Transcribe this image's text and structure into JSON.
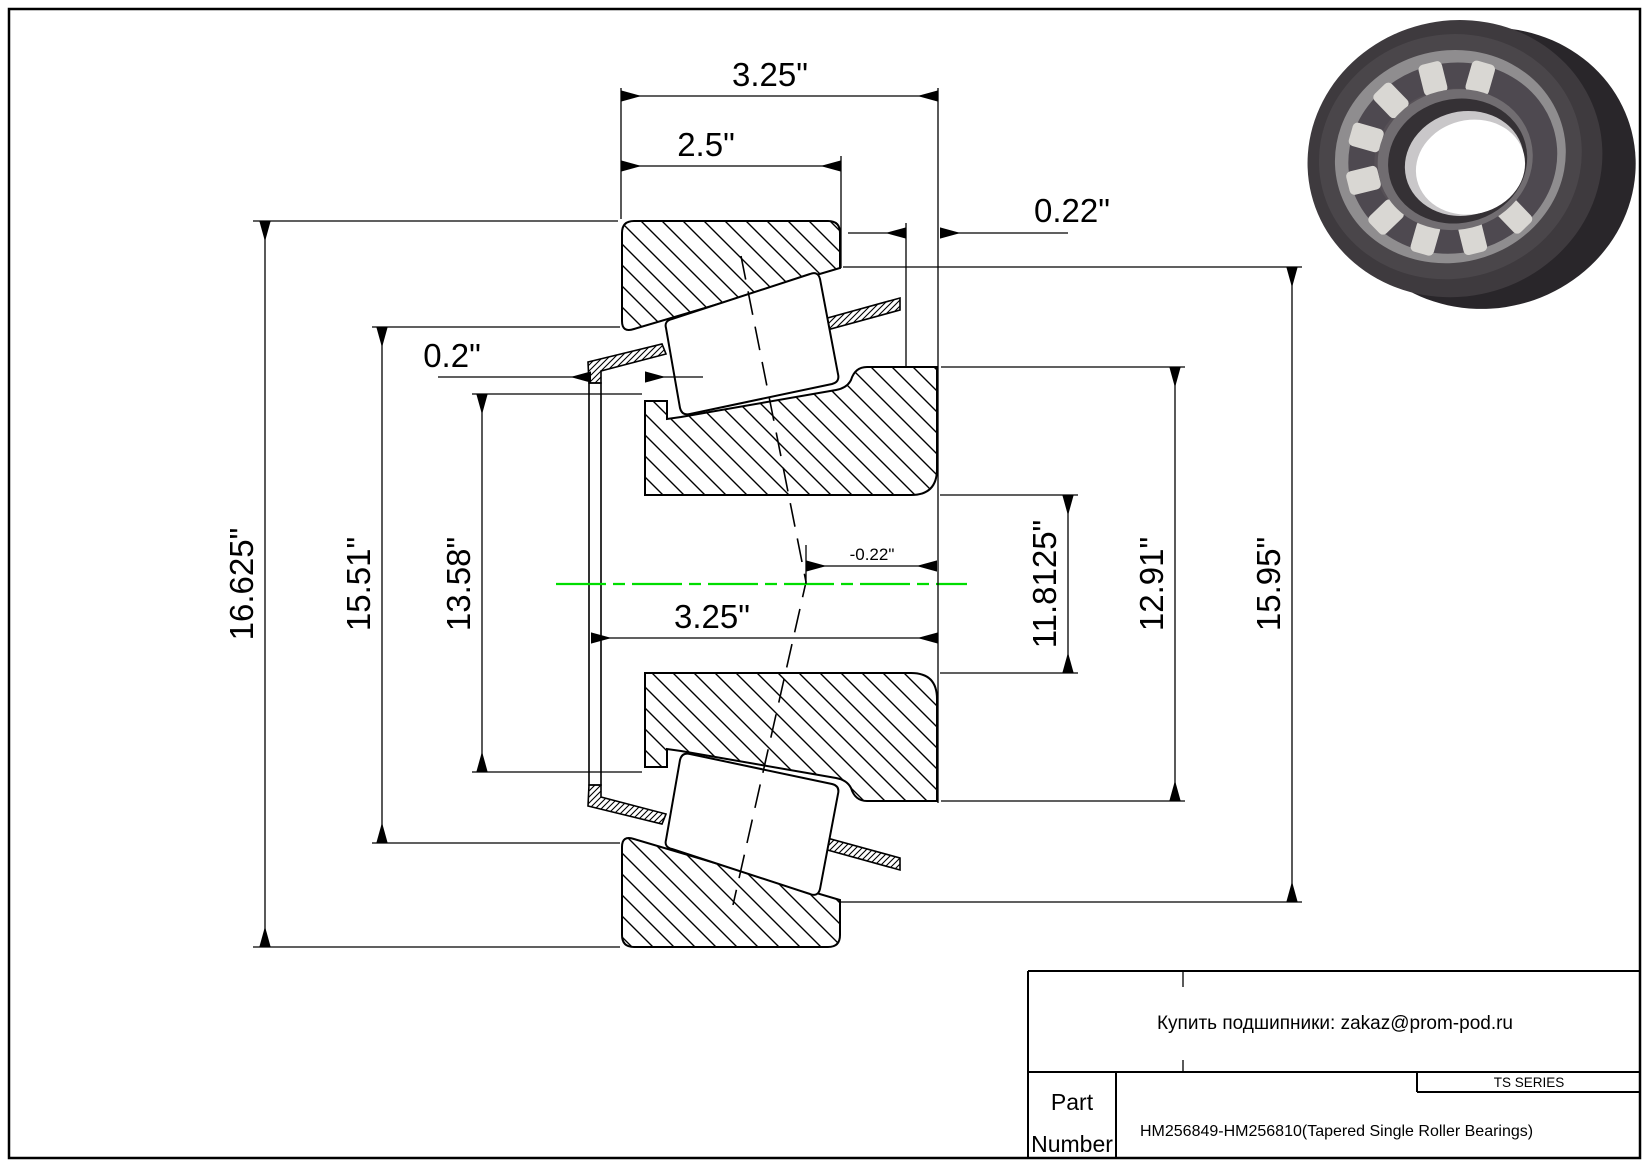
{
  "colors": {
    "centerline": "#00dd00",
    "line": "#000000"
  },
  "drawing": {
    "dims": {
      "overall_width_top": "3.25\"",
      "cup_width": "2.5\"",
      "stickout_right": "0.22\"",
      "stickout_left": "0.2\"",
      "outer_diameter": "16.625\"",
      "flange_diameter": "15.51\"",
      "seal_diameter": "13.58\"",
      "cone_width": "3.25\"",
      "effective_center": "-0.22\"",
      "bore_diameter": "11.8125\"",
      "cone_back_diameter": "12.91\"",
      "cup_outer_diameter": "15.95\""
    }
  },
  "title_block": {
    "vendor_line": "Купить подшипники: zakaz@prom-pod.ru",
    "series": "TS SERIES",
    "part_label_1": "Part",
    "part_label_2": "Number",
    "part_number": "HM256849-HM256810(Tapered Single Roller Bearings)"
  }
}
